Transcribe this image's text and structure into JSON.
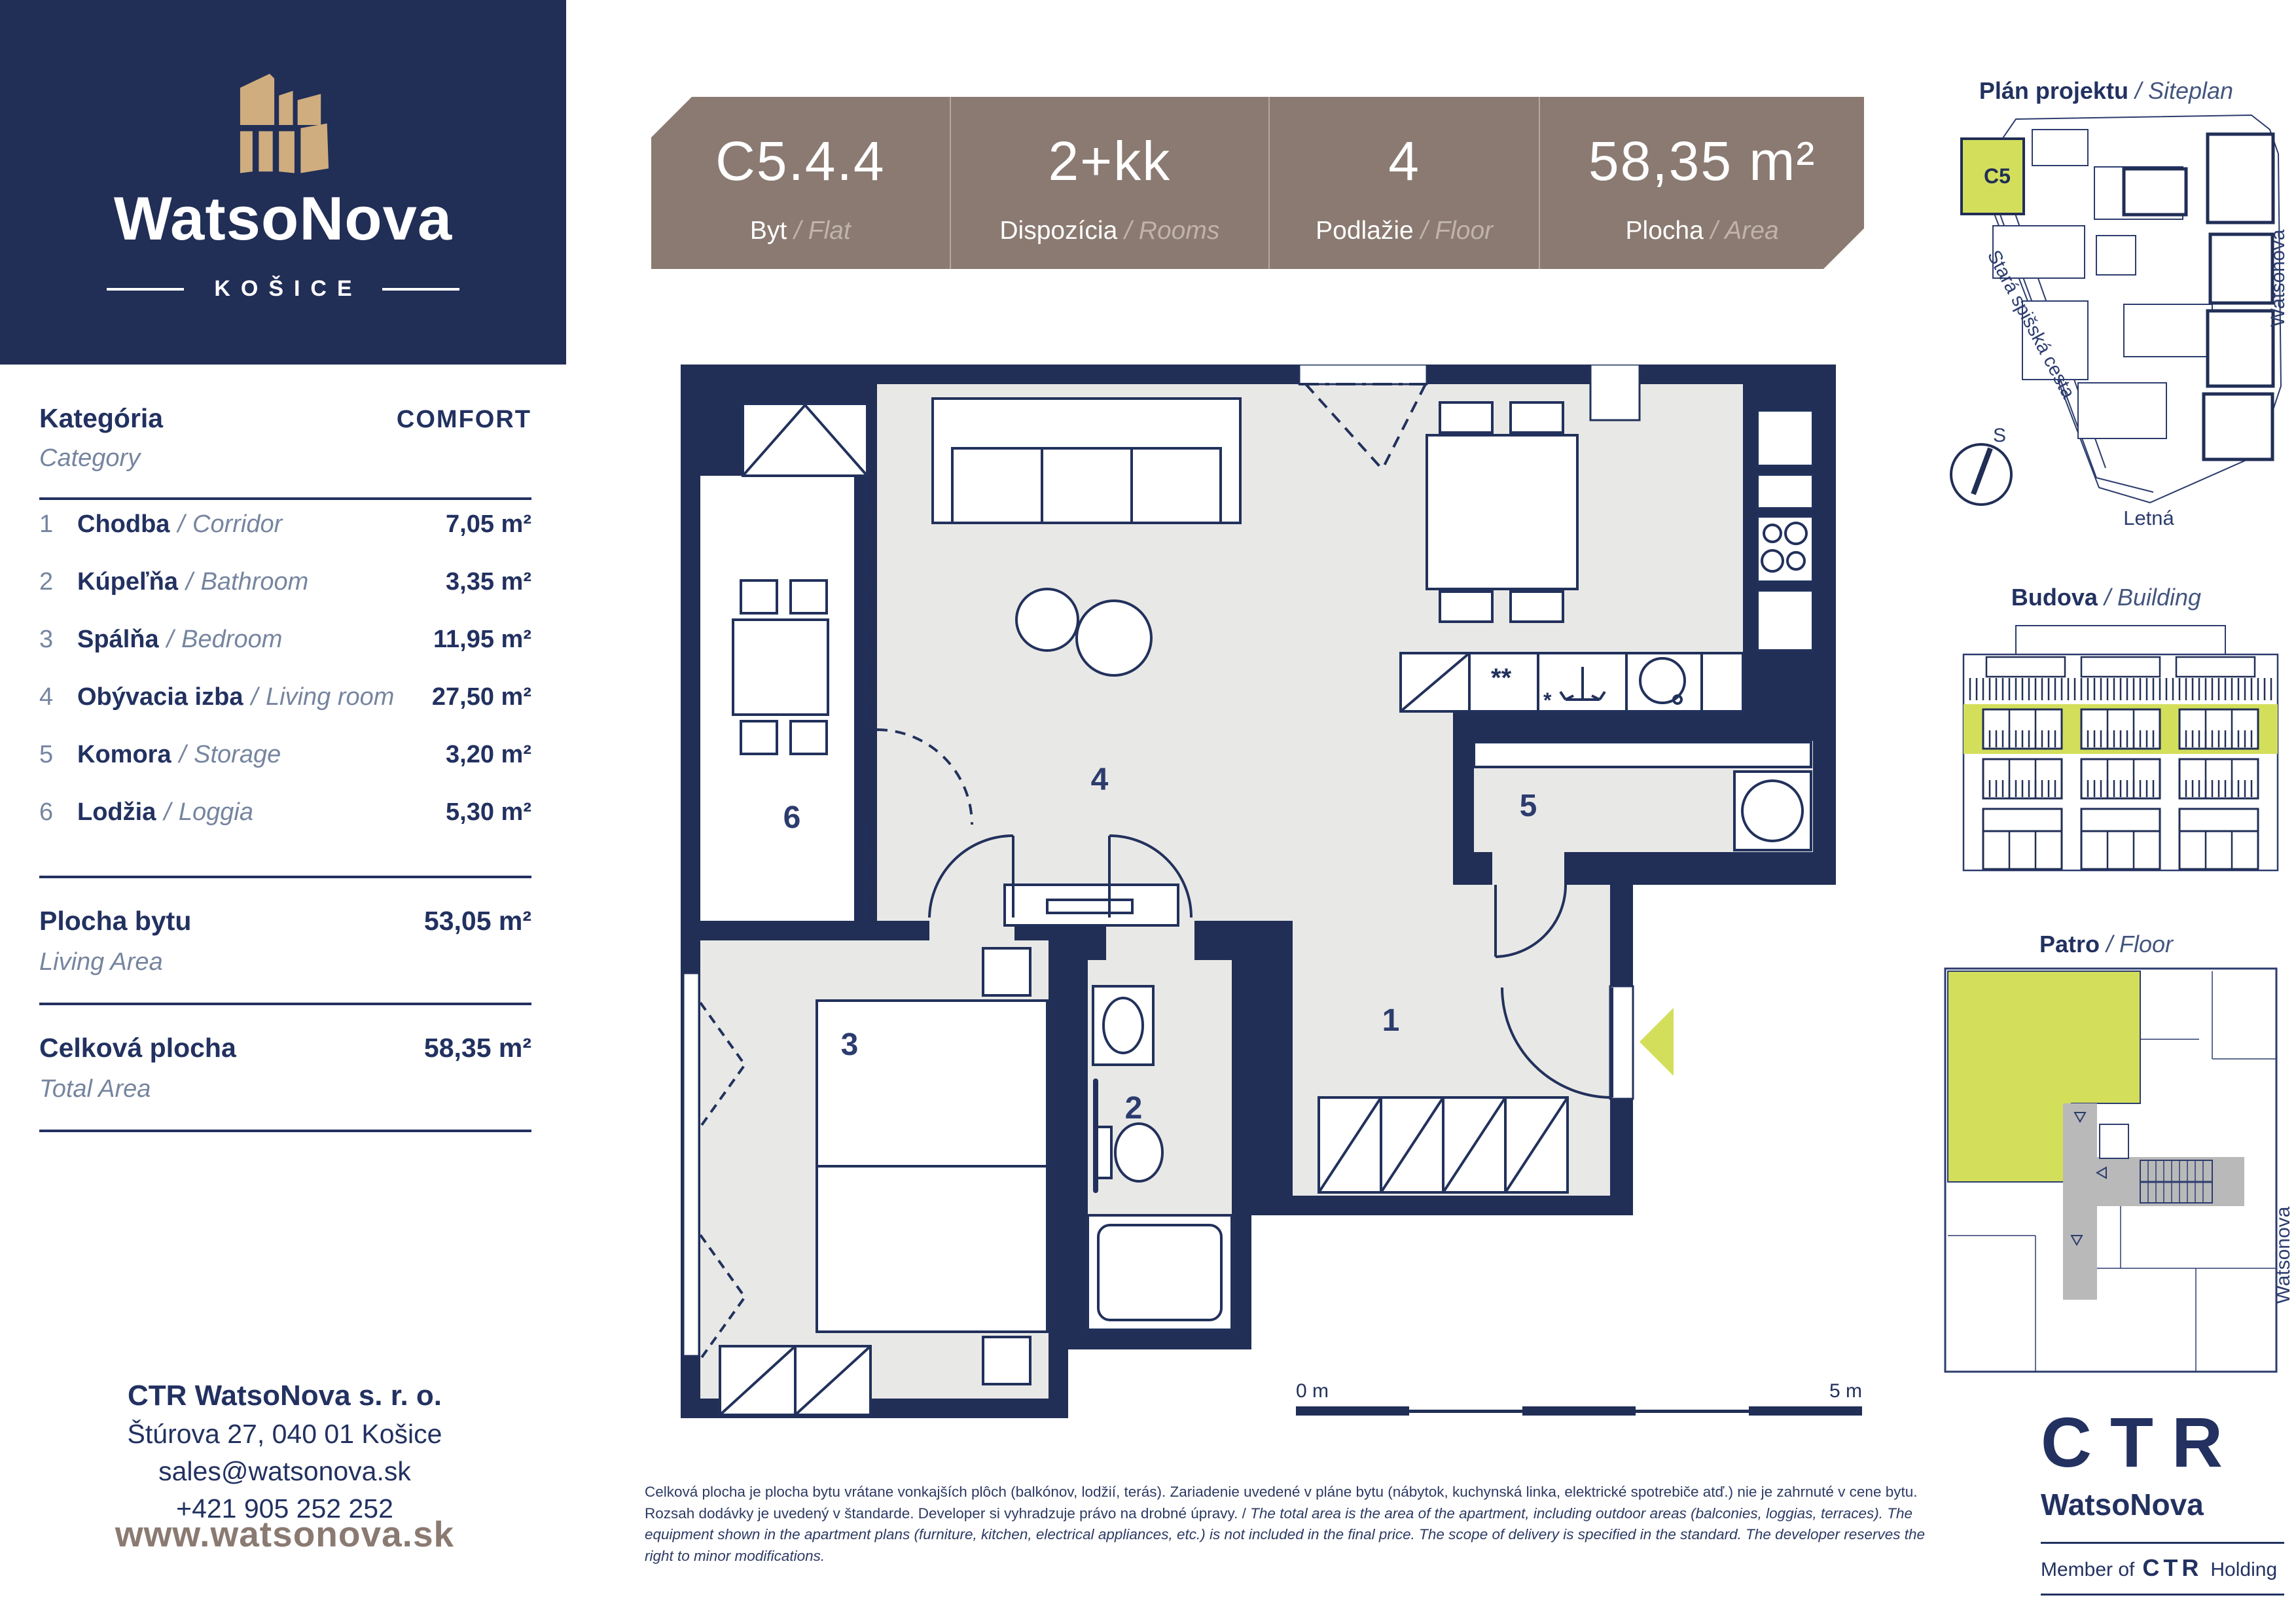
{
  "ui": {
    "sep": "/"
  },
  "brand": {
    "name": "WatsoNova",
    "city": "KOŠICE"
  },
  "header": {
    "cells": [
      {
        "value": "C5.4.4",
        "label_sk": "Byt",
        "label_en": "Flat"
      },
      {
        "value": "2+kk",
        "label_sk": "Dispozícia",
        "label_en": "Rooms"
      },
      {
        "value": "4",
        "label_sk": "Podlažie",
        "label_en": "Floor"
      },
      {
        "value": "58,35 m²",
        "label_sk": "Plocha",
        "label_en": "Area"
      }
    ]
  },
  "category": {
    "label_sk": "Kategória",
    "label_en": "Category",
    "value": "COMFORT"
  },
  "rooms": [
    {
      "num": "1",
      "name_sk": "Chodba",
      "name_en": "Corridor",
      "area": "7,05 m²"
    },
    {
      "num": "2",
      "name_sk": "Kúpeľňa",
      "name_en": "Bathroom",
      "area": "3,35 m²"
    },
    {
      "num": "3",
      "name_sk": "Spálňa",
      "name_en": "Bedroom",
      "area": "11,95 m²"
    },
    {
      "num": "4",
      "name_sk": "Obývacia izba",
      "name_en": "Living room",
      "area": "27,50 m²"
    },
    {
      "num": "5",
      "name_sk": "Komora",
      "name_en": "Storage",
      "area": "3,20 m²"
    },
    {
      "num": "6",
      "name_sk": "Lodžia",
      "name_en": "Loggia",
      "area": "5,30 m²"
    }
  ],
  "totals": [
    {
      "label_sk": "Plocha bytu",
      "label_en": "Living Area",
      "value": "53,05 m²"
    },
    {
      "label_sk": "Celková plocha",
      "label_en": "Total Area",
      "value": "58,35 m²"
    }
  ],
  "plan": {
    "labels": {
      "r1": "1",
      "r2": "2",
      "r3": "3",
      "r4": "4",
      "r5": "5",
      "r6": "6"
    },
    "symbols": {
      "freezer": "**",
      "freezer2": "*"
    },
    "scale": {
      "start": "0 m",
      "end": "5 m"
    }
  },
  "siteplan": {
    "title_sk": "Plán projektu",
    "title_en": "Siteplan",
    "highlight": "C5",
    "street_left": "Stará spišská cesta",
    "street_right": "Watsonova",
    "street_bottom": "Letná",
    "compass": "S"
  },
  "building": {
    "title_sk": "Budova",
    "title_en": "Building"
  },
  "floor_mini": {
    "title_sk": "Patro",
    "title_en": "Floor",
    "street_right": "Watsonova"
  },
  "contact": {
    "company": "CTR WatsoNova s. r. o.",
    "address": "Štúrova 27, 040 01 Košice",
    "email": "sales@watsonova.sk",
    "phone": "+421 905 252 252",
    "website": "www.watsonova.sk"
  },
  "footer": {
    "disclaimer_sk": "Celková plocha je plocha bytu vrátane vonkajších plôch (balkónov, lodžií, terás). Zariadenie uvedené v pláne bytu (nábytok, kuchynská linka, elektrické spotrebiče atď.) nie je zahrnuté v cene bytu. Rozsah dodávky je uvedený v štandarde. Developer si vyhradzuje právo na drobné úpravy.",
    "disclaimer_en": "The total area is the area of the apartment, including outdoor areas (balconies, loggias, terraces). The equipment shown in the apartment plans (furniture, kitchen, electrical appliances, etc.) is not included in the final price. The scope of delivery is specified in the standard. The developer reserves the right to minor modifications."
  },
  "ctr": {
    "logo": "CTR",
    "name": "WatsoNova",
    "member_prefix": "Member of",
    "member_logo": "CTR",
    "member_suffix": "Holding"
  },
  "colors": {
    "navy": "#212e56",
    "taupe": "#8a7a71",
    "lime": "#d3df5b",
    "floor_gray": "#e8e8e6"
  }
}
